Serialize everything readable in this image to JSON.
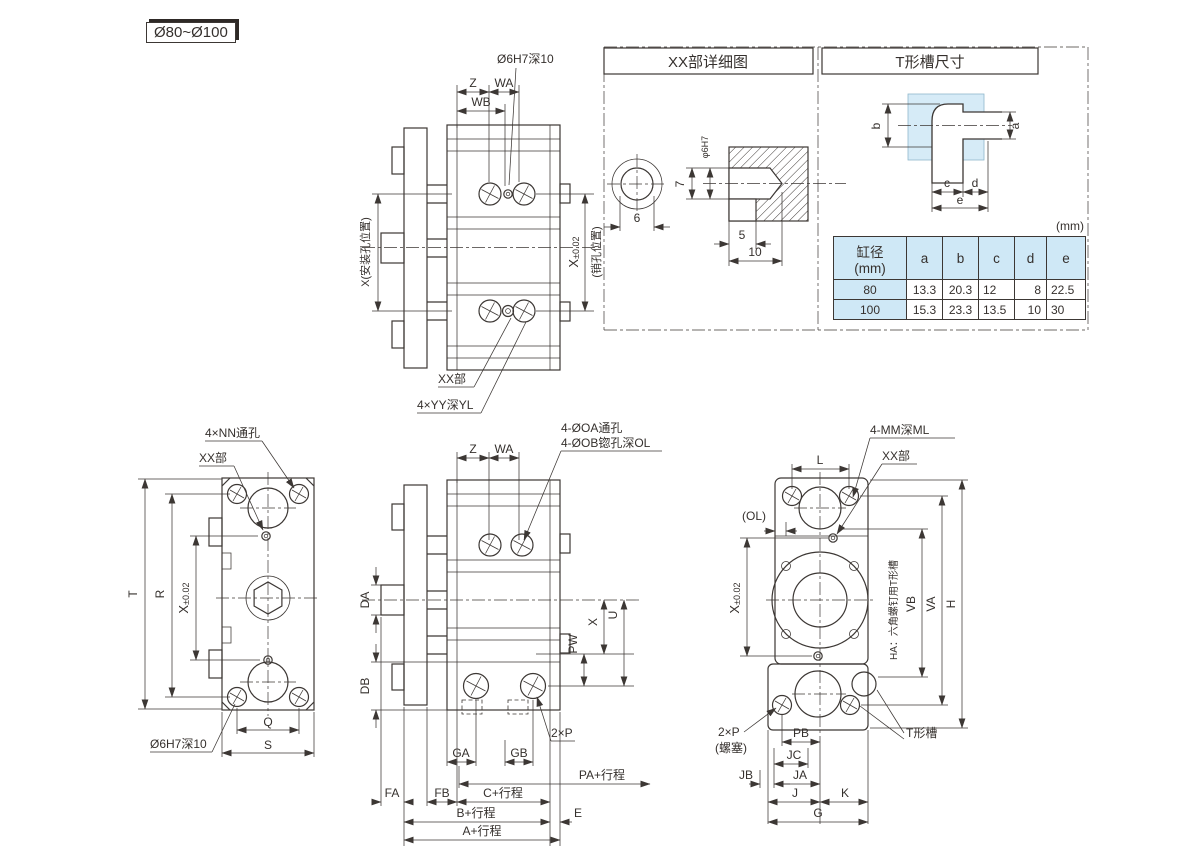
{
  "colors": {
    "line": "#3c3734",
    "highlight": "#d6ebf7",
    "table_fill": "#cfe8f6",
    "background": "#ffffff"
  },
  "badge": {
    "label": "Ø80~Ø100"
  },
  "top_drawing": {
    "pin_hole_note": "Ø6H7深10",
    "dim_z": "Z",
    "dim_wa": "WA",
    "dim_wb": "WB",
    "left_dim": "X(安装孔位置)",
    "right_dim_main": "X",
    "right_dim_tol": "±0.02",
    "right_dim_note": "(销孔位置)",
    "xx_label": "XX部",
    "yy_note": "4×YY深YL"
  },
  "detail_panel": {
    "xx_title": "XX部详细图",
    "t_title": "T形槽尺寸",
    "xx_detail": {
      "dia": "φ6H7",
      "depth": "7",
      "width": "6",
      "step": "5",
      "total": "10"
    },
    "t_slot": {
      "a": "a",
      "b": "b",
      "c": "c",
      "d": "d",
      "e": "e"
    },
    "unit": "(mm)",
    "table": {
      "bore_header": "缸径",
      "bore_unit": "(mm)",
      "cols": [
        "a",
        "b",
        "c",
        "d",
        "e"
      ],
      "rows": [
        {
          "bore": "80",
          "a": "13.3",
          "b": "20.3",
          "c": "12",
          "d": "8",
          "e": "22.5"
        },
        {
          "bore": "100",
          "a": "15.3",
          "b": "23.3",
          "c": "13.5",
          "d": "10",
          "e": "30"
        }
      ]
    }
  },
  "front_drawing": {
    "nn_note": "4×NN通孔",
    "xx_label": "XX部",
    "dim_t": "T",
    "dim_r": "R",
    "dim_x_main": "X",
    "dim_x_tol": "±0.02",
    "pin_hole_note": "Ø6H7深10",
    "dim_q": "Q",
    "dim_s": "S"
  },
  "side_drawing": {
    "dim_z": "Z",
    "dim_wa": "WA",
    "oa_note": "4-ØOA通孔",
    "ob_note": "4-ØOB锪孔深OL",
    "dim_da": "DA",
    "dim_db": "DB",
    "dim_x": "X",
    "dim_u": "U",
    "dim_pw": "PW",
    "port_note": "2×P",
    "dim_ga": "GA",
    "dim_gb": "GB",
    "dim_pa": "PA+行程",
    "dim_fa": "FA",
    "dim_fb": "FB",
    "dim_c": "C+行程",
    "dim_b": "B+行程",
    "dim_e": "E",
    "dim_a": "A+行程"
  },
  "end_drawing": {
    "dim_l": "L",
    "mm_note": "4-MM深ML",
    "xx_label": "XX部",
    "ol_note": "(OL)",
    "dim_x_main": "X",
    "dim_x_tol": "±0.02",
    "ha_note": "HA：六角螺钉用T形槽",
    "dim_vb": "VB",
    "dim_va": "VA",
    "dim_h": "H",
    "t_slot_label": "T形槽",
    "port_note": "2×P",
    "port_note2": "(螺塞)",
    "dim_pb": "PB",
    "dim_jc": "JC",
    "dim_jb": "JB",
    "dim_ja": "JA",
    "dim_j": "J",
    "dim_k": "K",
    "dim_g": "G"
  }
}
